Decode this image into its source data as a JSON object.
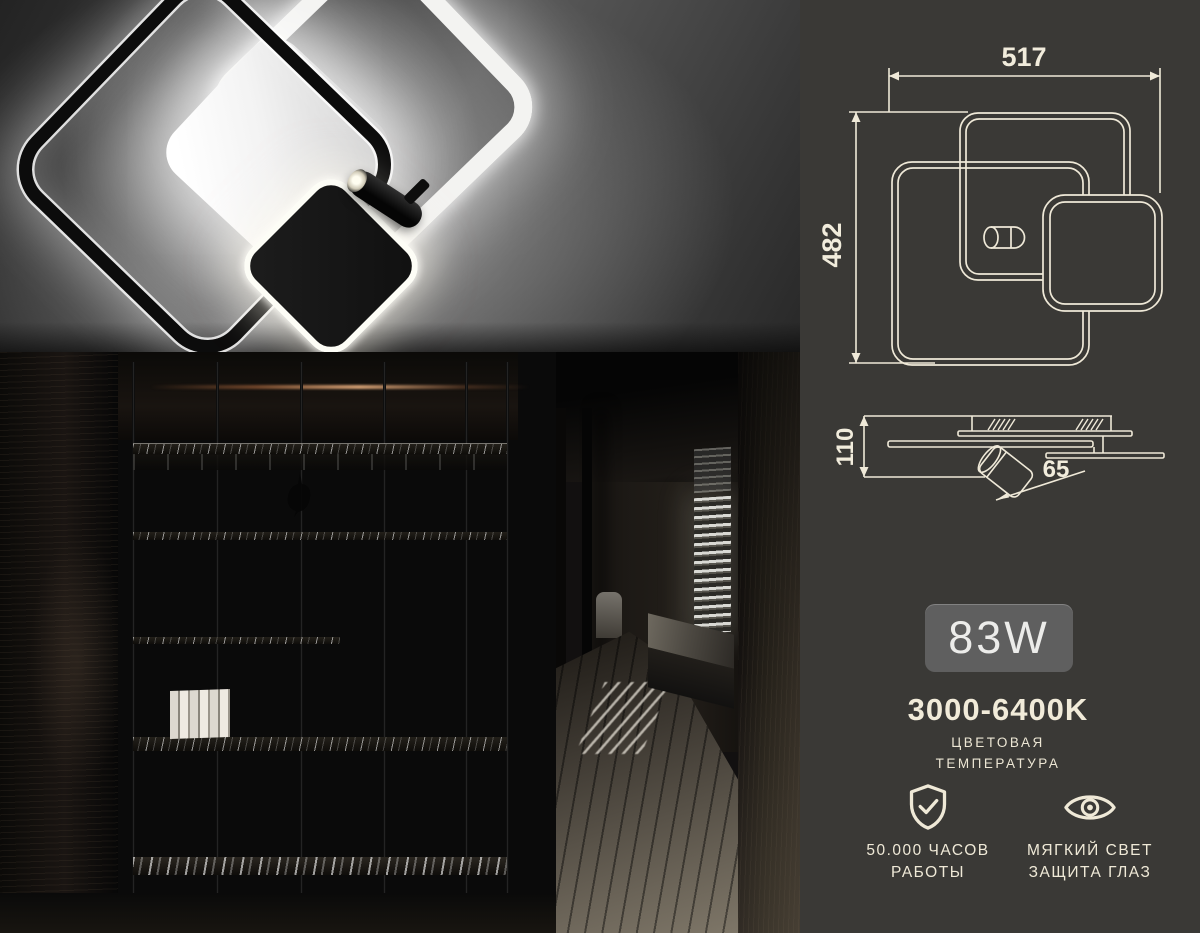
{
  "panel": {
    "background": "#3a3936",
    "accent_color": "#f1ebd9",
    "top_view": {
      "width_mm": "517",
      "height_mm": "482"
    },
    "side_view": {
      "height_mm": "110",
      "spot_mm": "65"
    },
    "power_badge": "83W",
    "color_temperature": {
      "value": "3000-6400K",
      "caption_line1": "ЦВЕТОВАЯ",
      "caption_line2": "ТЕМПЕРАТУРА"
    },
    "features": [
      {
        "icon": "shield-check-icon",
        "line1": "50.000 ЧАСОВ",
        "line2": "РАБОТЫ"
      },
      {
        "icon": "eye-icon",
        "line1": "МЯГКИЙ СВЕТ",
        "line2": "ЗАЩИТА ГЛАЗ"
      }
    ]
  }
}
